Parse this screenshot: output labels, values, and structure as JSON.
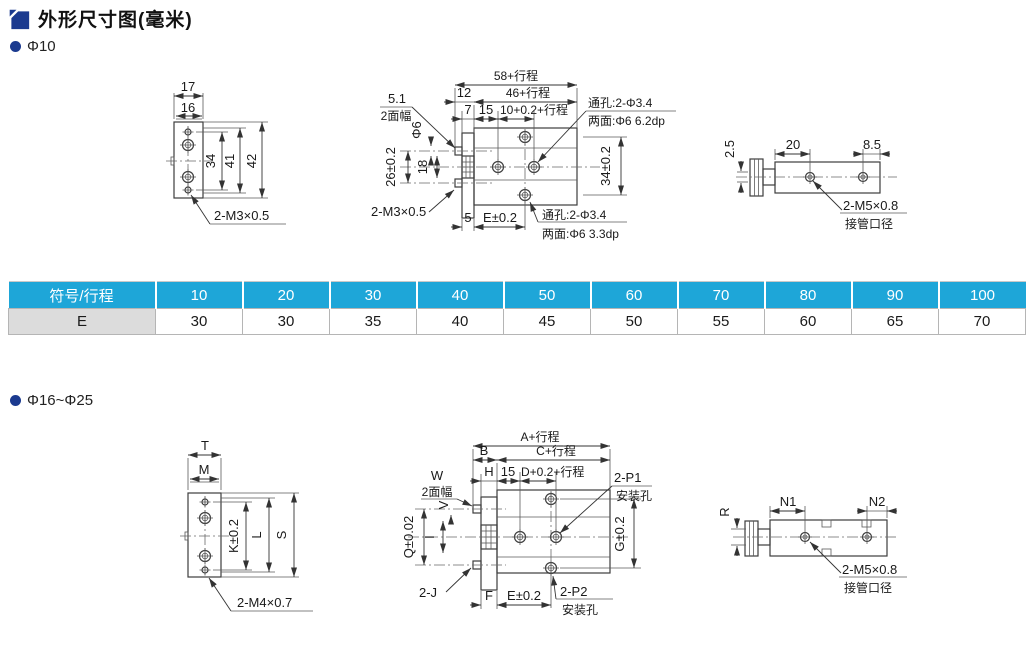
{
  "page": {
    "title": "外形尺寸图(毫米)",
    "section1_label": "Φ10",
    "section2_label": "Φ16~Φ25"
  },
  "table": {
    "header_label": "符号/行程",
    "strokes": [
      "10",
      "20",
      "30",
      "40",
      "50",
      "60",
      "70",
      "80",
      "90",
      "100"
    ],
    "row_label": "E",
    "values": [
      "30",
      "30",
      "35",
      "40",
      "45",
      "50",
      "55",
      "60",
      "65",
      "70"
    ]
  },
  "d1": {
    "w_outer": "17",
    "w_inner": "16",
    "h_inner": "34",
    "h_mid": "41",
    "h_outer": "42",
    "thread": "2-M3×0.5"
  },
  "d2": {
    "len_total": "58+行程",
    "len_12": "12",
    "len_46": "46+行程",
    "len_7": "7",
    "len_15": "15",
    "len_bore": "10+0.2+行程",
    "flat_w": "5.1",
    "flat_label": "2面幅",
    "rod_dia": "Φ6",
    "rod_span": "26±0.2",
    "dim_18": "18",
    "hole_span": "34±0.2",
    "thru_top_1": "通孔:2-Φ3.4",
    "thru_top_2": "两面:Φ6 6.2dp",
    "thru_bot_1": "通孔:2-Φ3.4",
    "thru_bot_2": "两面:Φ6 3.3dp",
    "thread": "2-M3×0.5",
    "dim_5": "5",
    "dim_e": "E±0.2"
  },
  "d3": {
    "dim_25": "2.5",
    "dim_20": "20",
    "dim_85": "8.5",
    "port_thread": "2-M5×0.8",
    "port_label": "接管口径"
  },
  "d4": {
    "w_outer": "T",
    "w_inner": "M",
    "h_inner": "K±0.2",
    "h_mid": "L",
    "h_outer": "S",
    "thread": "2-M4×0.7"
  },
  "d5": {
    "len_total": "A+行程",
    "len_b": "B",
    "len_c": "C+行程",
    "len_h": "H",
    "len_15": "15",
    "len_bore": "D+0.2+行程",
    "flat_w": "W",
    "flat_label": "2面幅",
    "rod_dia": "V",
    "rod_span": "Q±0.02",
    "dim_i": "I",
    "hole_span": "G±0.2",
    "p1_1": "2-P1",
    "p1_2": "安装孔",
    "p2_1": "2-P2",
    "p2_2": "安装孔",
    "thread": "2-J",
    "dim_f": "F",
    "dim_e": "E±0.2"
  },
  "d6": {
    "dim_r": "R",
    "dim_n1": "N1",
    "dim_n2": "N2",
    "port_thread": "2-M5×0.8",
    "port_label": "接管口径"
  },
  "colors": {
    "header_blue": "#1ea6d8",
    "row_gray": "#dcdcdc",
    "accent_navy": "#1b3a8f",
    "line": "#3d3d3d"
  }
}
